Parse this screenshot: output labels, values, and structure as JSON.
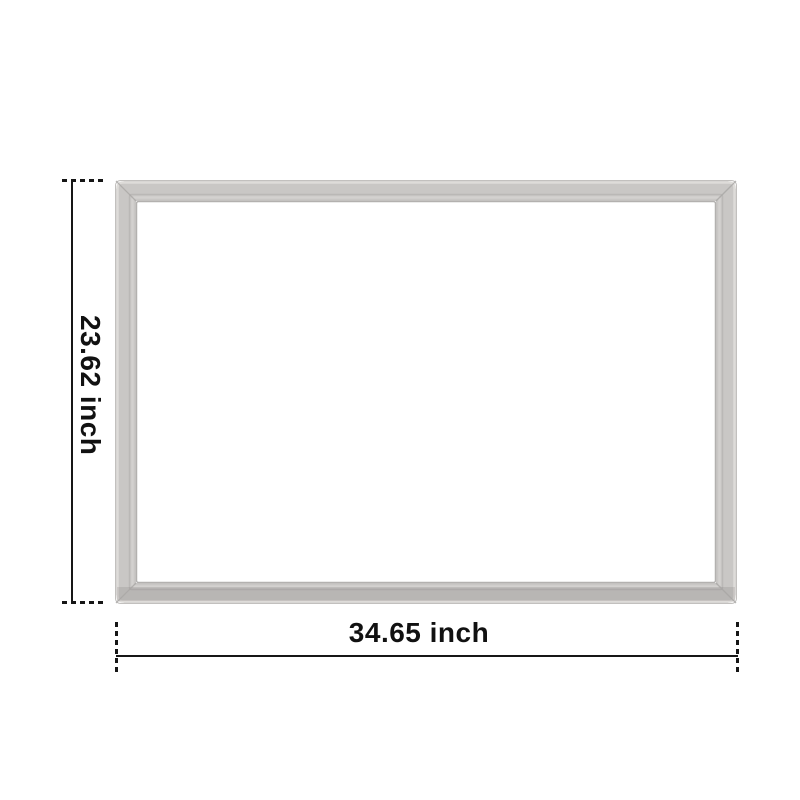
{
  "image": {
    "background_color": "#ffffff"
  },
  "gasket": {
    "color_main": "#c9c7c5",
    "color_highlight": "#dedcd9",
    "color_ridge_dark": "#b3b1af",
    "color_edge": "#c2c0be"
  },
  "annotations": {
    "line_color": "#161616",
    "height": {
      "label": "23.62 inch"
    },
    "width": {
      "label": "34.65 inch"
    }
  }
}
